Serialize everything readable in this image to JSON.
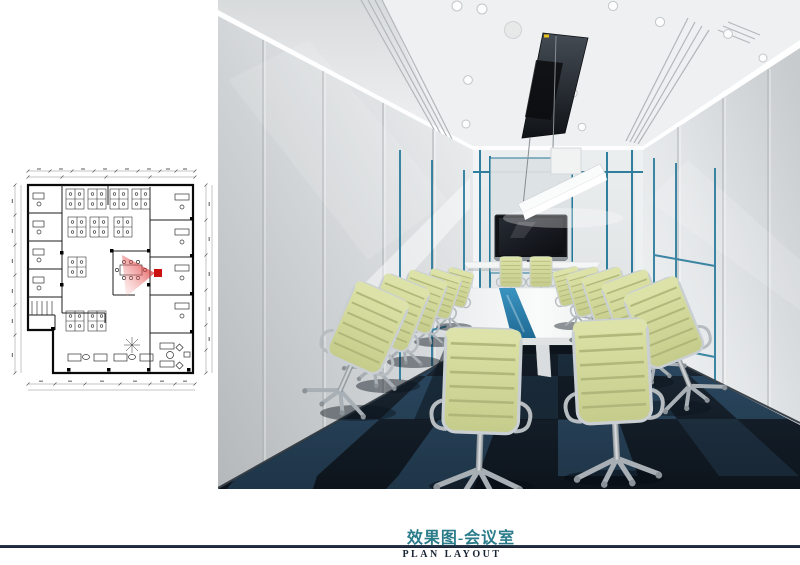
{
  "caption": {
    "title_zh": "效果图-会议室",
    "title_en": "PLAN LAYOUT"
  },
  "colors": {
    "caption_teal": "#2a7c8b",
    "divider_navy": "#1e2a3c",
    "plan_marker_red": "#cc1111",
    "wall_accent_teal": "#1d7396",
    "table_stripe_blue": "#2f86b2",
    "chair_fabric_green": "#d3d99c",
    "carpet_dark_navy": "#17222e",
    "carpet_light_blue": "#2f4d66",
    "wall_gray": "#d9dcde"
  },
  "icons": {
    "plan_view_cone": "camera-view-direction-marker"
  }
}
